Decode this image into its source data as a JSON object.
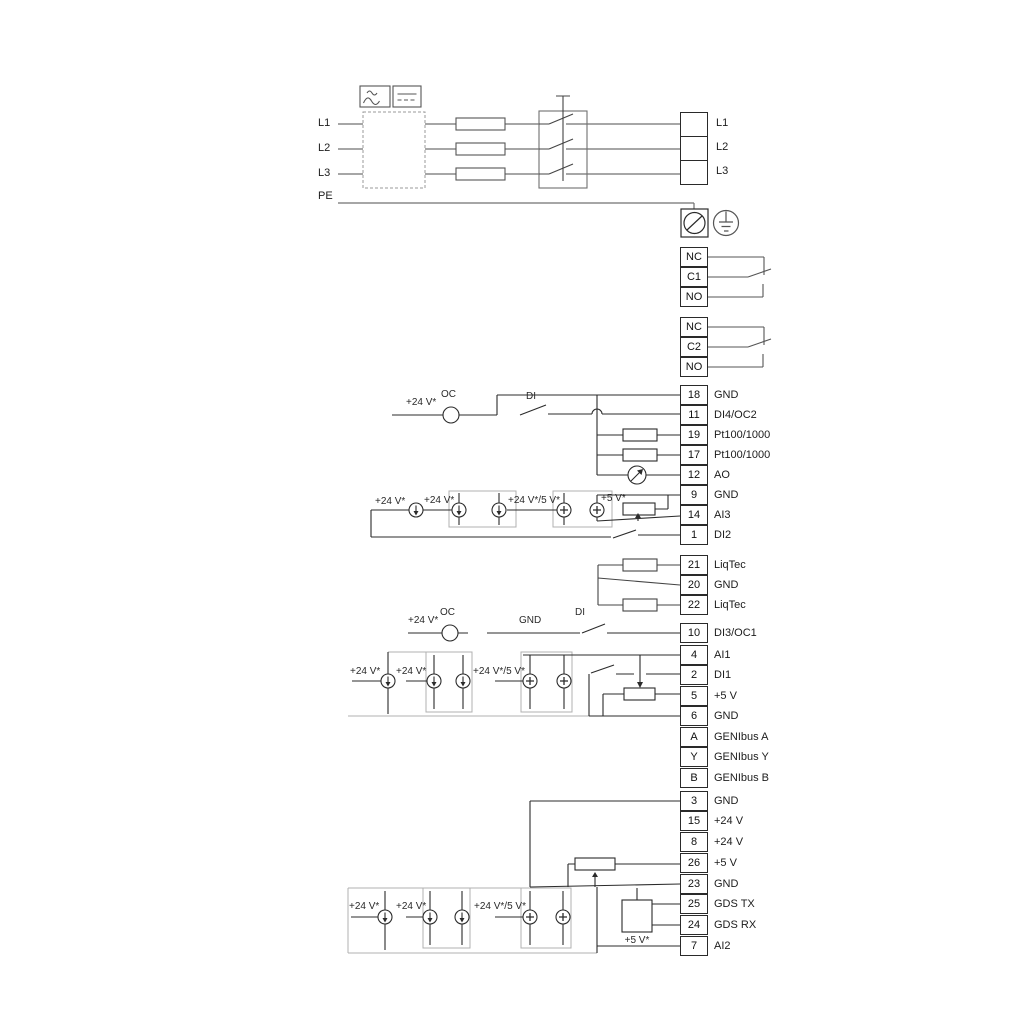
{
  "labels": {
    "v24": "+24 V*",
    "v24_5": "+24 V*/5 V*",
    "v5star": "+5 V*",
    "oc": "OC",
    "di": "DI",
    "gnd": "GND"
  },
  "power_input": {
    "phases": [
      "L1",
      "L2",
      "L3"
    ],
    "pe": "PE",
    "output_terminals": [
      "L1",
      "L2",
      "L3"
    ]
  },
  "relay1": {
    "terminals": [
      "NC",
      "C1",
      "NO"
    ]
  },
  "relay2": {
    "terminals": [
      "NC",
      "C2",
      "NO"
    ]
  },
  "io_groups": {
    "a": [
      {
        "id": "18",
        "label": "GND"
      },
      {
        "id": "11",
        "label": "DI4/OC2"
      },
      {
        "id": "19",
        "label": "Pt100/1000"
      },
      {
        "id": "17",
        "label": "Pt100/1000"
      },
      {
        "id": "12",
        "label": "AO"
      },
      {
        "id": "9",
        "label": "GND"
      },
      {
        "id": "14",
        "label": "AI3"
      },
      {
        "id": "1",
        "label": "DI2"
      }
    ],
    "b": [
      {
        "id": "21",
        "label": "LiqTec"
      },
      {
        "id": "20",
        "label": "GND"
      },
      {
        "id": "22",
        "label": "LiqTec"
      }
    ],
    "c": [
      {
        "id": "10",
        "label": "DI3/OC1"
      }
    ],
    "d": [
      {
        "id": "4",
        "label": "AI1"
      },
      {
        "id": "2",
        "label": "DI1"
      },
      {
        "id": "5",
        "label": "+5 V"
      },
      {
        "id": "6",
        "label": "GND"
      },
      {
        "id": "A",
        "label": "GENIbus A"
      },
      {
        "id": "Y",
        "label": "GENIbus Y"
      },
      {
        "id": "B",
        "label": "GENIbus B"
      }
    ],
    "e": [
      {
        "id": "3",
        "label": "GND"
      },
      {
        "id": "15",
        "label": "+24 V"
      },
      {
        "id": "8",
        "label": "+24 V"
      },
      {
        "id": "26",
        "label": "+5 V"
      },
      {
        "id": "23",
        "label": "GND"
      },
      {
        "id": "25",
        "label": "GDS TX"
      },
      {
        "id": "24",
        "label": "GDS RX"
      },
      {
        "id": "7",
        "label": "AI2"
      }
    ]
  }
}
